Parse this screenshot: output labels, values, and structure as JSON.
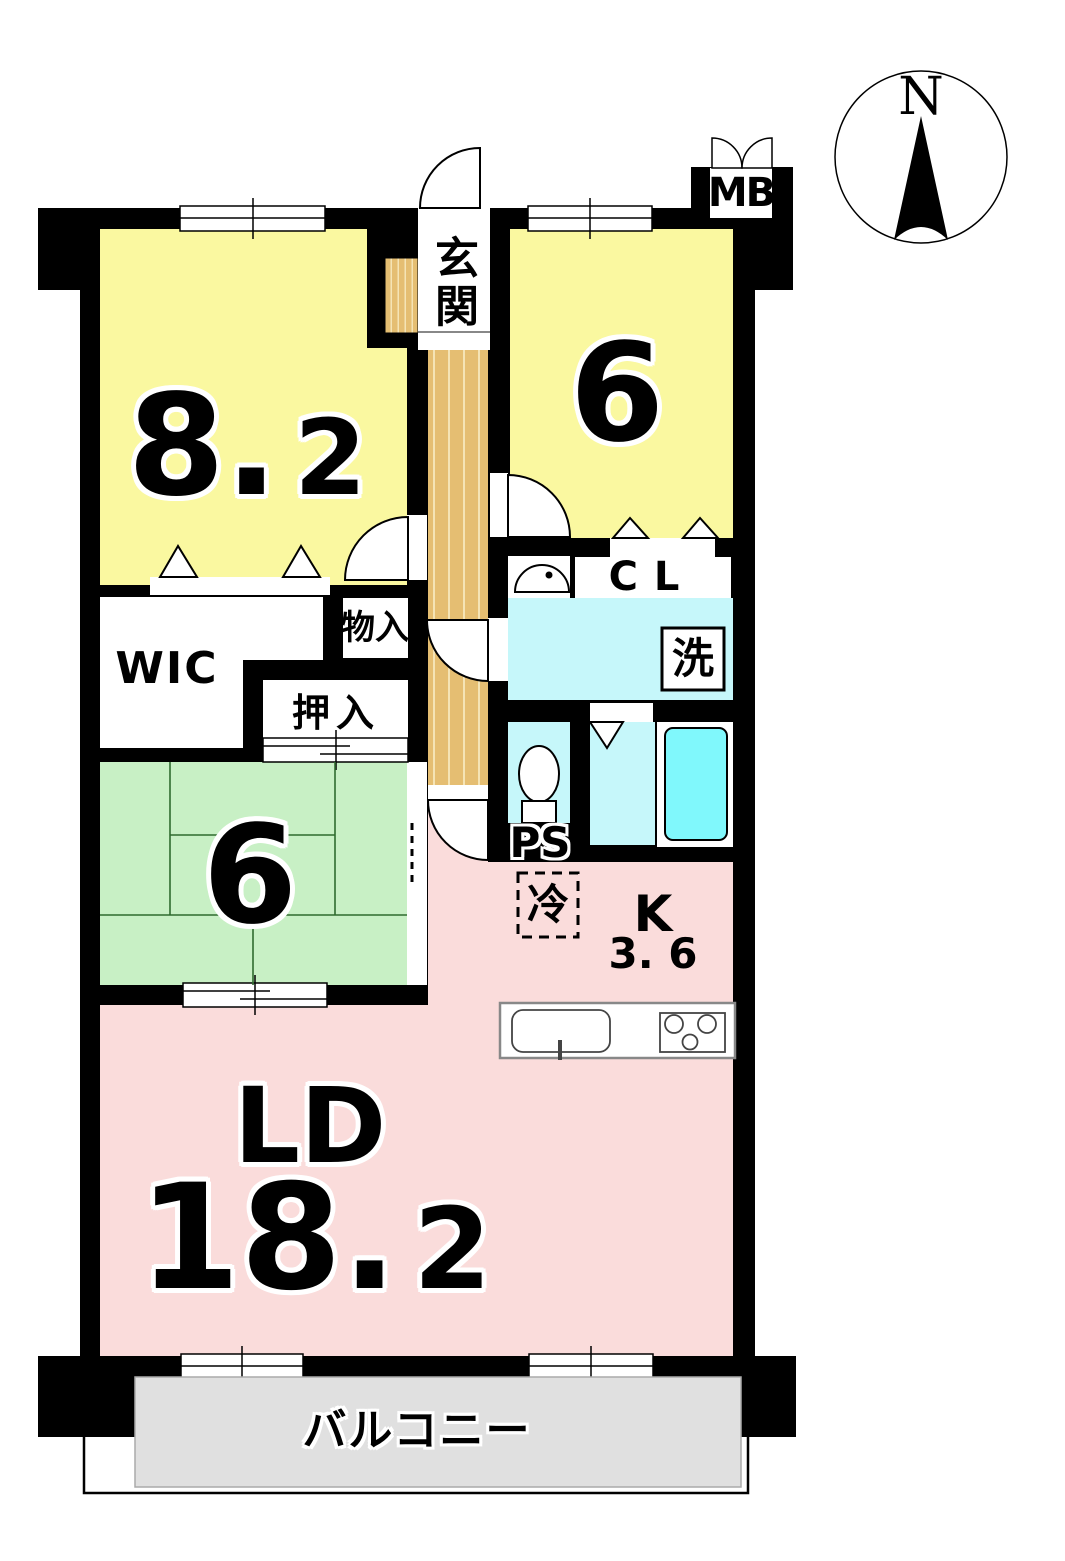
{
  "plan_title": "apartment-floor-plan",
  "colors": {
    "wall": "#000000",
    "room_yellow": "#FAF8A0",
    "tatami_green": "#C8F0C5",
    "ld_pink": "#FADCDB",
    "water_cyan": "#C6F7FA",
    "tub_cyan": "#80F8FC",
    "wood_tan": "#E5BE72",
    "wood_stripe": "#F5E4B5",
    "balcony_gray": "#E0E0E0"
  },
  "compass": {
    "north": "N"
  },
  "labels": {
    "meter_box": "MB",
    "entrance": "玄関",
    "room1_area": {
      "main": "8.",
      "sub": "2"
    },
    "room2_area": "6",
    "tatami_area": "6",
    "wic": "WIC",
    "storage": "物入",
    "oshiire": "押入",
    "closet": "CL",
    "washer": "洗",
    "pipe_space": "PS",
    "fridge": "冷",
    "kitchen": "K",
    "kitchen_area": "3. 6",
    "living": "LD",
    "living_area": {
      "main": "18.",
      "sub": "2"
    },
    "balcony": "バルコニー"
  }
}
